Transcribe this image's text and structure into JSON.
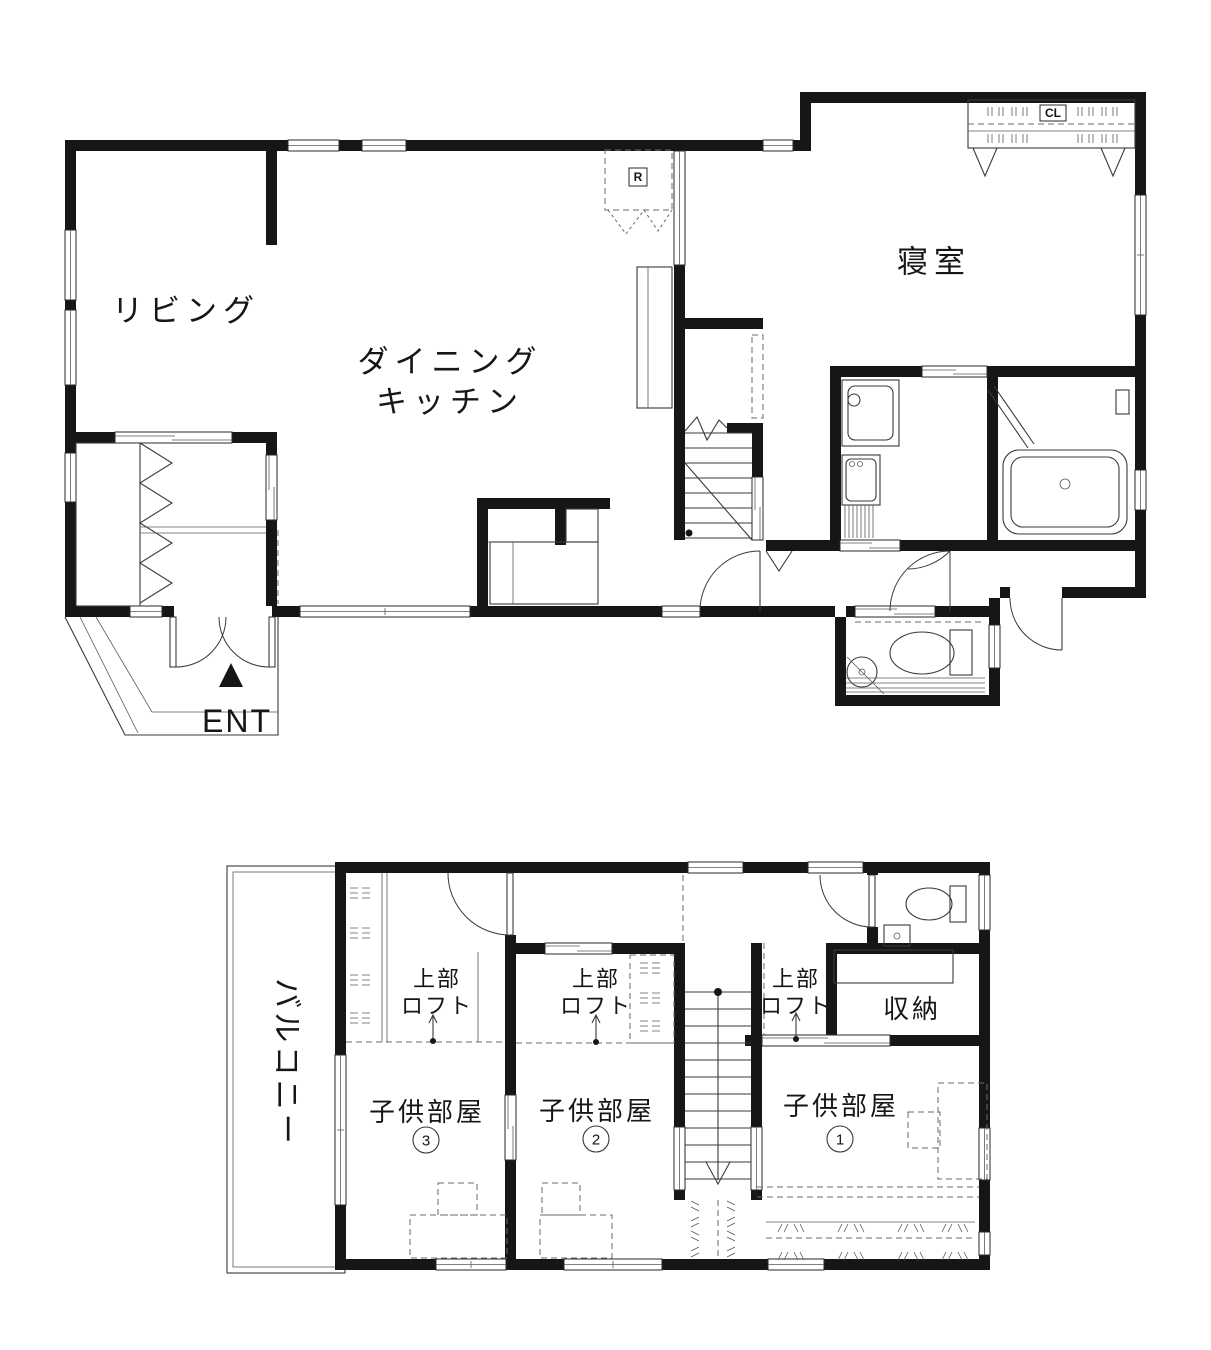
{
  "floor1": {
    "living": "リビング",
    "dining_line1": "ダイニング",
    "dining_line2": "キッチン",
    "bedroom": "寝室",
    "entrance": "ENT",
    "fridge": "R",
    "closet": "CL"
  },
  "floor2": {
    "balcony": "バルコニー",
    "storage": "収納",
    "loft_line1": "上部",
    "loft_line2": "ロフト",
    "rooms": [
      {
        "name": "子供部屋",
        "num": "1"
      },
      {
        "name": "子供部屋",
        "num": "2"
      },
      {
        "name": "子供部屋",
        "num": "3"
      }
    ]
  }
}
